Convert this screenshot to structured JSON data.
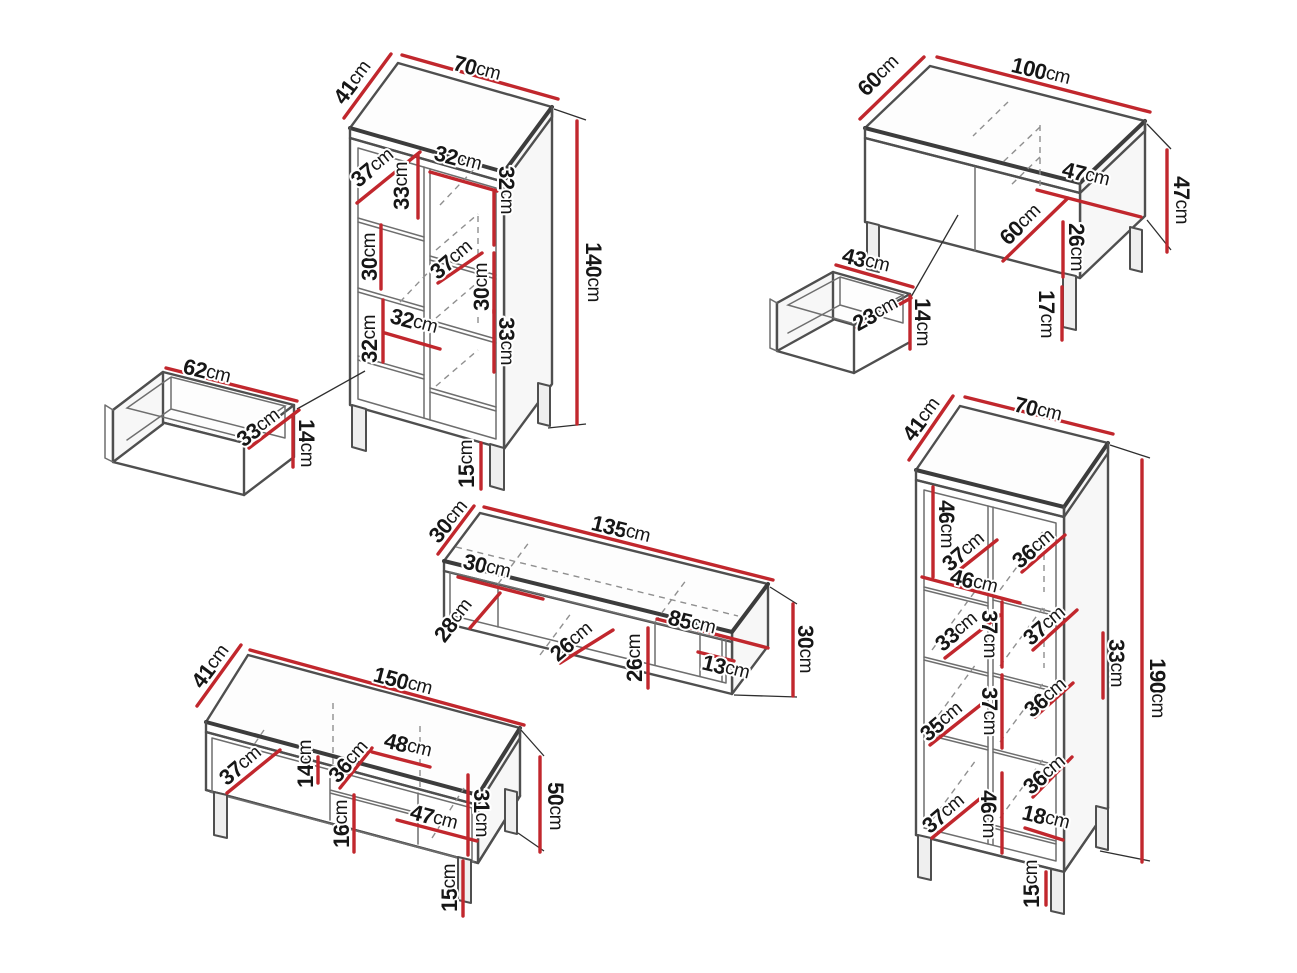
{
  "diagram": {
    "unit": "cm",
    "colors": {
      "background": "#ffffff",
      "dimension_line": "#c1272d",
      "edge": "#4f4f4f",
      "hidden_edge": "#8f8f8f",
      "text": "#161616"
    },
    "pieces": [
      {
        "id": "tall-cabinet",
        "overall_cm": {
          "width": 70,
          "depth": 41,
          "height": 140
        },
        "labels": [
          {
            "value": "41",
            "unit": "cm",
            "x": 352,
            "y": 82,
            "rotate": -53
          },
          {
            "value": "70",
            "unit": "cm",
            "x": 477,
            "y": 68,
            "rotate": 15
          },
          {
            "value": "140",
            "unit": "cm",
            "x": 594,
            "y": 272,
            "rotate": 90
          },
          {
            "value": "37",
            "unit": "cm",
            "x": 372,
            "y": 167,
            "rotate": -39
          },
          {
            "value": "33",
            "unit": "cm",
            "x": 401,
            "y": 186,
            "rotate": -90
          },
          {
            "value": "32",
            "unit": "cm",
            "x": 458,
            "y": 158,
            "rotate": 15
          },
          {
            "value": "32",
            "unit": "cm",
            "x": 507,
            "y": 190,
            "rotate": 90
          },
          {
            "value": "30",
            "unit": "cm",
            "x": 369,
            "y": 257,
            "rotate": -90
          },
          {
            "value": "37",
            "unit": "cm",
            "x": 451,
            "y": 259,
            "rotate": -40
          },
          {
            "value": "30",
            "unit": "cm",
            "x": 481,
            "y": 287,
            "rotate": -90
          },
          {
            "value": "32",
            "unit": "cm",
            "x": 369,
            "y": 339,
            "rotate": -90
          },
          {
            "value": "32",
            "unit": "cm",
            "x": 414,
            "y": 321,
            "rotate": 15
          },
          {
            "value": "33",
            "unit": "cm",
            "x": 507,
            "y": 341,
            "rotate": 90
          },
          {
            "value": "15",
            "unit": "cm",
            "x": 466,
            "y": 464,
            "rotate": -90
          }
        ]
      },
      {
        "id": "drawer-62",
        "overall_cm": {
          "width": 62,
          "depth": 33,
          "height": 14
        },
        "labels": [
          {
            "value": "62",
            "unit": "cm",
            "x": 207,
            "y": 371,
            "rotate": 14
          },
          {
            "value": "33",
            "unit": "cm",
            "x": 258,
            "y": 427,
            "rotate": -37
          },
          {
            "value": "14",
            "unit": "cm",
            "x": 307,
            "y": 443,
            "rotate": 90
          }
        ]
      },
      {
        "id": "coffee-table",
        "overall_cm": {
          "width": 100,
          "depth": 60,
          "height": 47
        },
        "labels": [
          {
            "value": "60",
            "unit": "cm",
            "x": 878,
            "y": 75,
            "rotate": -44
          },
          {
            "value": "100",
            "unit": "cm",
            "x": 1041,
            "y": 71,
            "rotate": 14
          },
          {
            "value": "47",
            "unit": "cm",
            "x": 1182,
            "y": 200,
            "rotate": 90
          },
          {
            "value": "47",
            "unit": "cm",
            "x": 1086,
            "y": 174,
            "rotate": 14
          },
          {
            "value": "60",
            "unit": "cm",
            "x": 1020,
            "y": 224,
            "rotate": -44
          },
          {
            "value": "26",
            "unit": "cm",
            "x": 1077,
            "y": 247,
            "rotate": 90
          },
          {
            "value": "17",
            "unit": "cm",
            "x": 1047,
            "y": 314,
            "rotate": 90
          }
        ]
      },
      {
        "id": "drawer-43",
        "overall_cm": {
          "width": 43,
          "depth": 23,
          "height": 14
        },
        "labels": [
          {
            "value": "43",
            "unit": "cm",
            "x": 866,
            "y": 260,
            "rotate": 14
          },
          {
            "value": "23",
            "unit": "cm",
            "x": 875,
            "y": 313,
            "rotate": -29
          },
          {
            "value": "14",
            "unit": "cm",
            "x": 923,
            "y": 322,
            "rotate": 90
          }
        ]
      },
      {
        "id": "wall-shelf",
        "overall_cm": {
          "width": 135,
          "depth": 30,
          "height": 30
        },
        "labels": [
          {
            "value": "30",
            "unit": "cm",
            "x": 448,
            "y": 521,
            "rotate": -50
          },
          {
            "value": "135",
            "unit": "cm",
            "x": 621,
            "y": 529,
            "rotate": 14
          },
          {
            "value": "30",
            "unit": "cm",
            "x": 487,
            "y": 566,
            "rotate": 14
          },
          {
            "value": "28",
            "unit": "cm",
            "x": 453,
            "y": 620,
            "rotate": -52
          },
          {
            "value": "26",
            "unit": "cm",
            "x": 571,
            "y": 641,
            "rotate": -40
          },
          {
            "value": "26",
            "unit": "cm",
            "x": 634,
            "y": 658,
            "rotate": -90
          },
          {
            "value": "85",
            "unit": "cm",
            "x": 692,
            "y": 622,
            "rotate": 14
          },
          {
            "value": "13",
            "unit": "cm",
            "x": 726,
            "y": 667,
            "rotate": 14
          },
          {
            "value": "30",
            "unit": "cm",
            "x": 806,
            "y": 649,
            "rotate": 90
          }
        ]
      },
      {
        "id": "tv-stand",
        "overall_cm": {
          "width": 150,
          "depth": 41,
          "height": 50
        },
        "labels": [
          {
            "value": "41",
            "unit": "cm",
            "x": 210,
            "y": 666,
            "rotate": -53
          },
          {
            "value": "150",
            "unit": "cm",
            "x": 403,
            "y": 681,
            "rotate": 15
          },
          {
            "value": "50",
            "unit": "cm",
            "x": 556,
            "y": 806,
            "rotate": 90
          },
          {
            "value": "37",
            "unit": "cm",
            "x": 240,
            "y": 765,
            "rotate": -40
          },
          {
            "value": "14",
            "unit": "cm",
            "x": 305,
            "y": 764,
            "rotate": -90
          },
          {
            "value": "36",
            "unit": "cm",
            "x": 348,
            "y": 761,
            "rotate": -48
          },
          {
            "value": "48",
            "unit": "cm",
            "x": 408,
            "y": 745,
            "rotate": 14
          },
          {
            "value": "16",
            "unit": "cm",
            "x": 341,
            "y": 824,
            "rotate": -90
          },
          {
            "value": "47",
            "unit": "cm",
            "x": 434,
            "y": 817,
            "rotate": 15
          },
          {
            "value": "31",
            "unit": "cm",
            "x": 482,
            "y": 813,
            "rotate": 90
          },
          {
            "value": "15",
            "unit": "cm",
            "x": 449,
            "y": 888,
            "rotate": -90
          }
        ]
      },
      {
        "id": "bookcase",
        "overall_cm": {
          "width": 70,
          "depth": 41,
          "height": 190
        },
        "labels": [
          {
            "value": "41",
            "unit": "cm",
            "x": 921,
            "y": 419,
            "rotate": -53
          },
          {
            "value": "70",
            "unit": "cm",
            "x": 1038,
            "y": 409,
            "rotate": 14
          },
          {
            "value": "190",
            "unit": "cm",
            "x": 1158,
            "y": 688,
            "rotate": 90
          },
          {
            "value": "46",
            "unit": "cm",
            "x": 947,
            "y": 524,
            "rotate": 90
          },
          {
            "value": "37",
            "unit": "cm",
            "x": 963,
            "y": 551,
            "rotate": -40
          },
          {
            "value": "36",
            "unit": "cm",
            "x": 1033,
            "y": 548,
            "rotate": -40
          },
          {
            "value": "46",
            "unit": "cm",
            "x": 974,
            "y": 581,
            "rotate": 14
          },
          {
            "value": "33",
            "unit": "cm",
            "x": 956,
            "y": 631,
            "rotate": -40
          },
          {
            "value": "37",
            "unit": "cm",
            "x": 990,
            "y": 634,
            "rotate": 90
          },
          {
            "value": "37",
            "unit": "cm",
            "x": 1044,
            "y": 625,
            "rotate": -40
          },
          {
            "value": "33",
            "unit": "cm",
            "x": 1117,
            "y": 663,
            "rotate": 90
          },
          {
            "value": "35",
            "unit": "cm",
            "x": 941,
            "y": 721,
            "rotate": -40
          },
          {
            "value": "37",
            "unit": "cm",
            "x": 990,
            "y": 711,
            "rotate": 90
          },
          {
            "value": "36",
            "unit": "cm",
            "x": 1045,
            "y": 697,
            "rotate": -40
          },
          {
            "value": "36",
            "unit": "cm",
            "x": 1044,
            "y": 774,
            "rotate": -40
          },
          {
            "value": "37",
            "unit": "cm",
            "x": 943,
            "y": 813,
            "rotate": -40
          },
          {
            "value": "46",
            "unit": "cm",
            "x": 989,
            "y": 814,
            "rotate": 90
          },
          {
            "value": "18",
            "unit": "cm",
            "x": 1046,
            "y": 817,
            "rotate": 14
          },
          {
            "value": "15",
            "unit": "cm",
            "x": 1031,
            "y": 884,
            "rotate": -90
          }
        ]
      }
    ]
  }
}
